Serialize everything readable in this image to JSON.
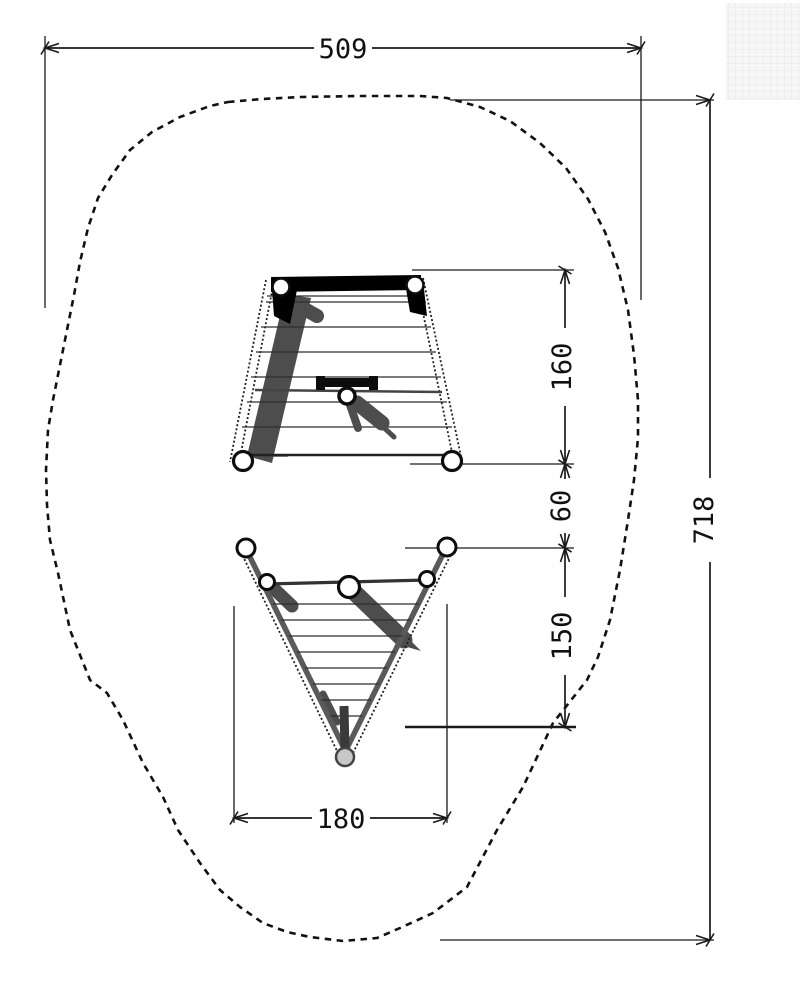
{
  "drawing": {
    "dimension_labels": {
      "width_total": "509",
      "height_total": "718",
      "upper_net": "160",
      "gap": "60",
      "lower_net": "150",
      "lower_net_width": "180"
    },
    "colors": {
      "line": "#1a1a1a",
      "shadow": "#4d4d4d",
      "background": "#ffffff",
      "grid_patch_bg": "#f6f6f6",
      "grid_patch_line": "#e7e7e7"
    }
  }
}
